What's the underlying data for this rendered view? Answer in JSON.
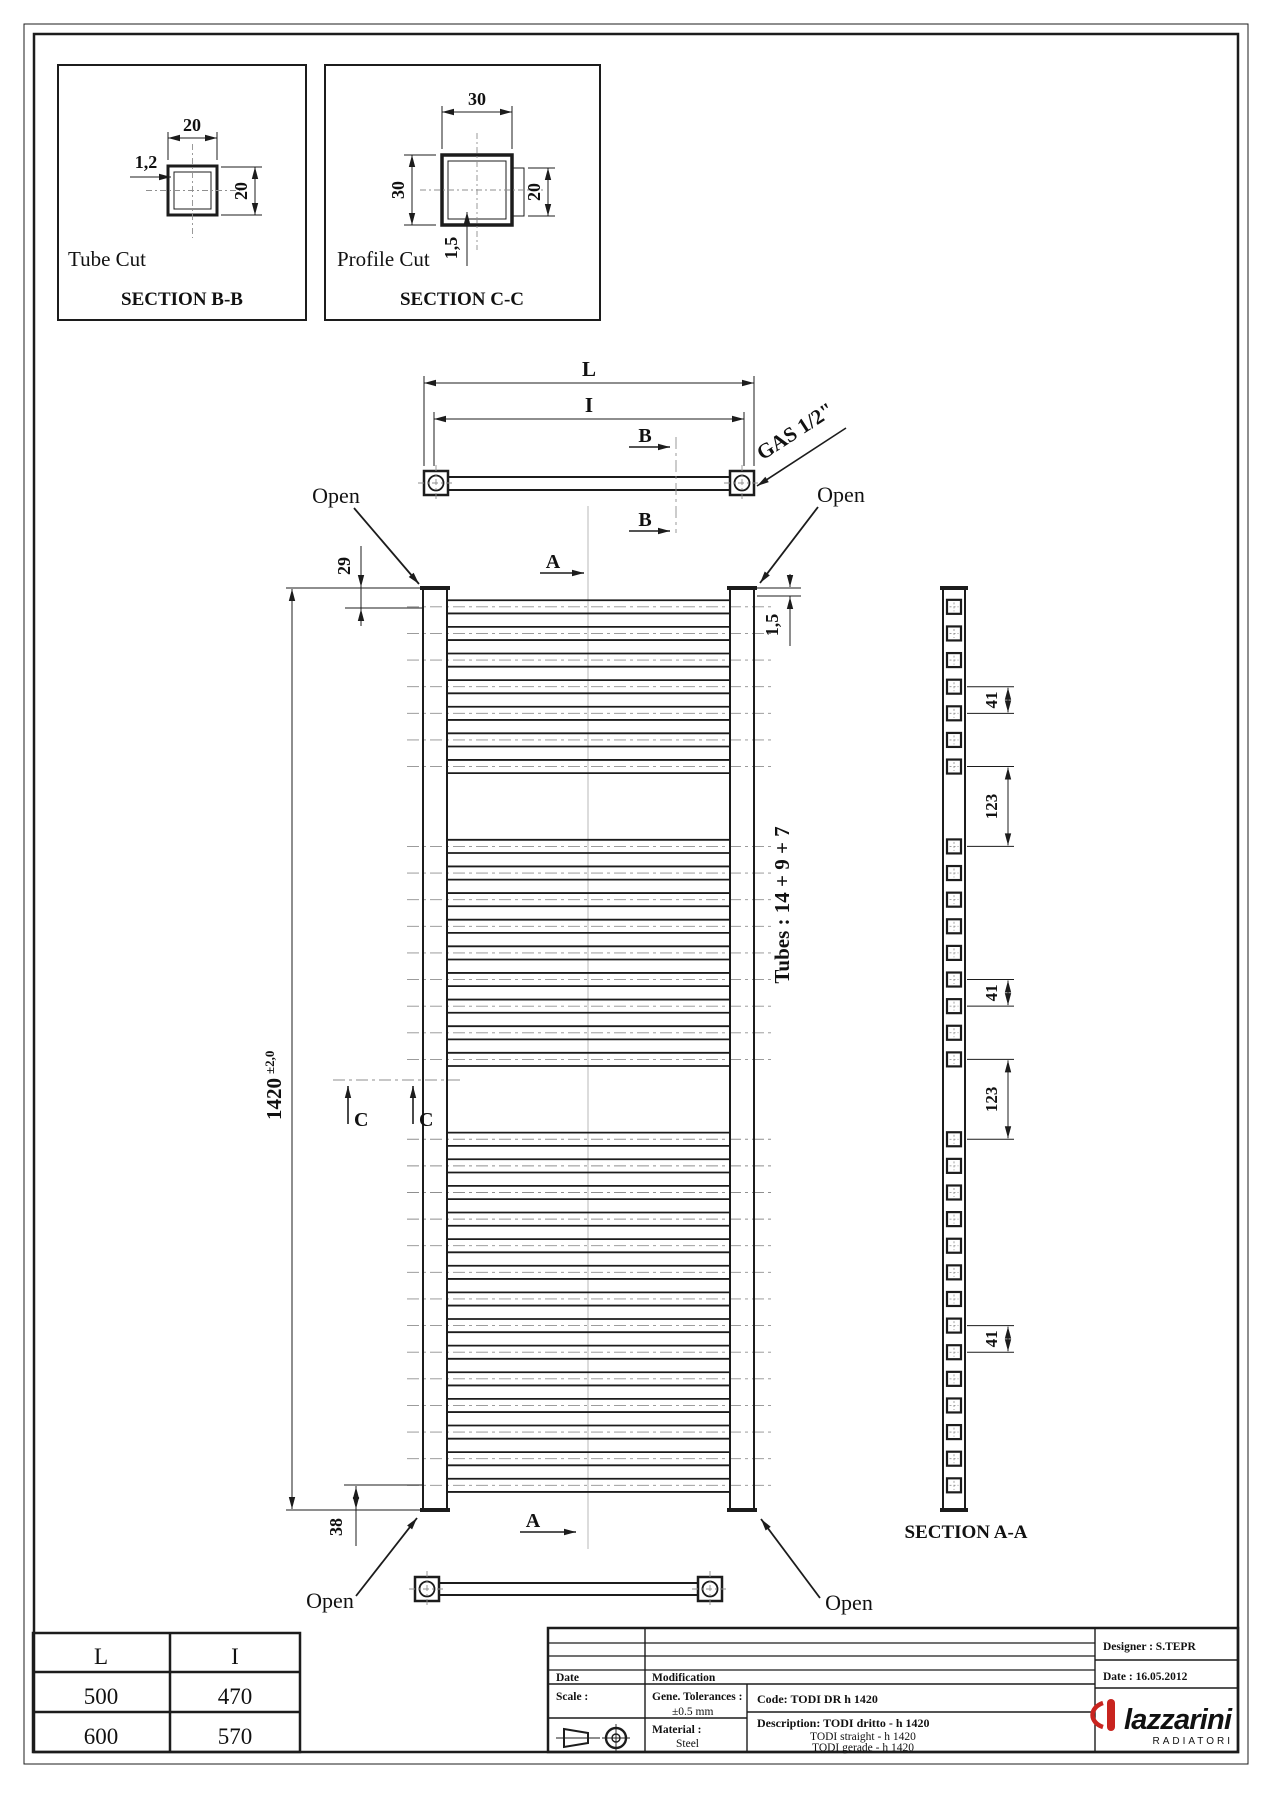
{
  "drawing": {
    "section_bb": {
      "title": "Tube Cut",
      "label": "SECTION B-B",
      "dim_width": "20",
      "dim_height": "20",
      "dim_wall": "1,2"
    },
    "section_cc": {
      "title": "Profile Cut",
      "label": "SECTION C-C",
      "dim_width": "30",
      "dim_height": "30",
      "dim_tube": "20",
      "dim_wall": "1,5"
    },
    "top_view": {
      "dim_outer": "L",
      "dim_inner": "I",
      "cut_b": "B",
      "gas_label": "GAS 1/2\"",
      "open_left": "Open",
      "open_right": "Open"
    },
    "front_view": {
      "cut_a": "A",
      "cut_c": "C",
      "dim_top": "29",
      "dim_wall_top": "1,5",
      "dim_height": "1420",
      "dim_height_tol": "±2,0",
      "dim_bottom": "38",
      "open_bottom_left": "Open",
      "open_bottom_right": "Open",
      "tubes_label": "Tubes : 14 + 9 + 7"
    },
    "section_aa": {
      "label": "SECTION A-A",
      "brackets": [
        {
          "from": 3,
          "to": 4,
          "label": "41"
        },
        {
          "from": 6,
          "to": 7,
          "label": "123"
        },
        {
          "from": 12,
          "to": 13,
          "label": "41"
        },
        {
          "from": 15,
          "to": 16,
          "label": "123"
        },
        {
          "from": 23,
          "to": 24,
          "label": "41"
        }
      ]
    },
    "radiator": {
      "height_mm": 1420,
      "pitch_mm": 41,
      "gap_mm": 123,
      "top_offset_mm": 29,
      "bottom_offset_mm": 38,
      "groups_top_to_bottom": [
        7,
        9,
        14
      ]
    }
  },
  "size_table": {
    "headers": [
      "L",
      "I"
    ],
    "rows": [
      [
        "500",
        "470"
      ],
      [
        "600",
        "570"
      ]
    ]
  },
  "title_block": {
    "date_label": "Date",
    "modification_label": "Modification",
    "scale_label": "Scale :",
    "tolerances_label": "Gene. Tolerances :",
    "tolerances_value": "±0.5 mm",
    "material_label": "Material :",
    "material_value": "Steel",
    "code": "Code: TODI DR h 1420",
    "description_line1": "Description: TODI dritto - h 1420",
    "description_line2": "TODI straight - h 1420",
    "description_line3": "TODI gerade - h 1420",
    "designer": "Designer : S.TEPR",
    "date": "Date : 16.05.2012"
  },
  "brand": {
    "name": "lazzarini",
    "tagline": "RADIATORI",
    "red": "#c8241f",
    "gray": "#9b9b9b"
  }
}
